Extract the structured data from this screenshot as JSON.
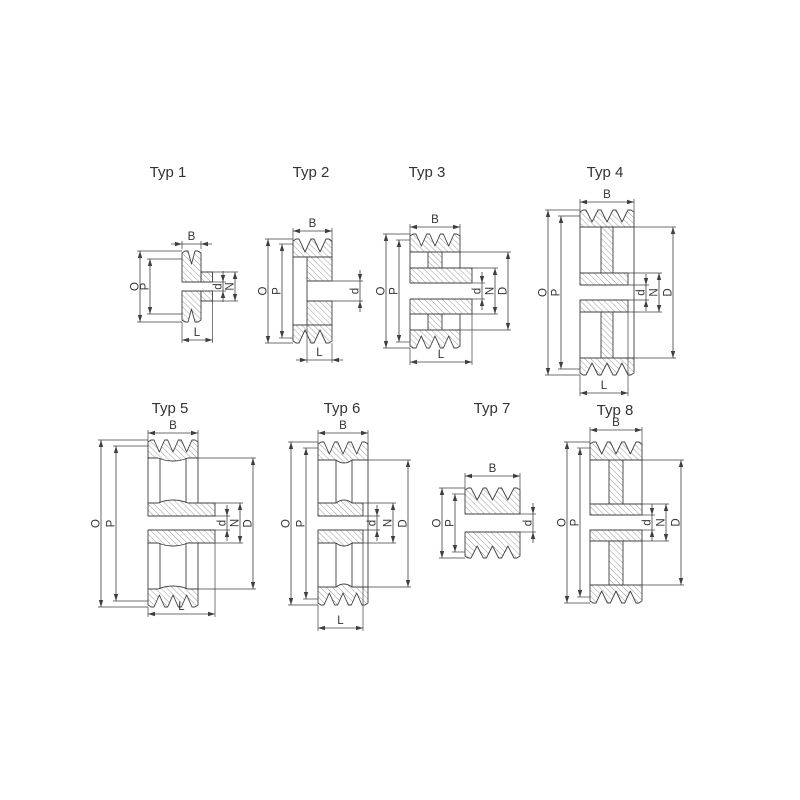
{
  "page": {
    "background": "#ffffff",
    "description": "Technical drawing sheet of 8 V-belt pulley cross-section types"
  },
  "style": {
    "line_color": "#3f3f3f",
    "hatch_color": "#4a4a4a",
    "text_color": "#333333"
  },
  "figures": {
    "typ1": {
      "title": "Typ 1",
      "grooves": 1,
      "labels": {
        "B": "B",
        "O": "O",
        "P": "P",
        "d": "d",
        "N": "N",
        "L": "L"
      }
    },
    "typ2": {
      "title": "Typ 2",
      "grooves": 2,
      "labels": {
        "B": "B",
        "O": "O",
        "P": "P",
        "d": "d",
        "L": "L"
      }
    },
    "typ3": {
      "title": "Typ 3",
      "grooves": 3,
      "labels": {
        "B": "B",
        "O": "O",
        "P": "P",
        "d": "d",
        "N": "N",
        "D": "D",
        "L": "L"
      }
    },
    "typ4": {
      "title": "Typ 4",
      "grooves": 3,
      "labels": {
        "B": "B",
        "O": "O",
        "P": "P",
        "d": "d",
        "N": "N",
        "D": "D",
        "L": "L"
      }
    },
    "typ5": {
      "title": "Typ 5",
      "grooves": 3,
      "labels": {
        "B": "B",
        "O": "O",
        "P": "P",
        "d": "d",
        "N": "N",
        "D": "D",
        "L": "L"
      }
    },
    "typ6": {
      "title": "Typ 6",
      "grooves": 3,
      "labels": {
        "B": "B",
        "O": "O",
        "P": "P",
        "d": "d",
        "N": "N",
        "D": "D",
        "L": "L"
      }
    },
    "typ7": {
      "title": "Typ 7",
      "grooves": 3,
      "labels": {
        "B": "B",
        "O": "O",
        "P": "P",
        "d": "d"
      }
    },
    "typ8": {
      "title": "Typ 8",
      "grooves": 3,
      "labels": {
        "B": "B",
        "O": "O",
        "P": "P",
        "d": "d",
        "N": "N",
        "D": "D"
      }
    }
  }
}
